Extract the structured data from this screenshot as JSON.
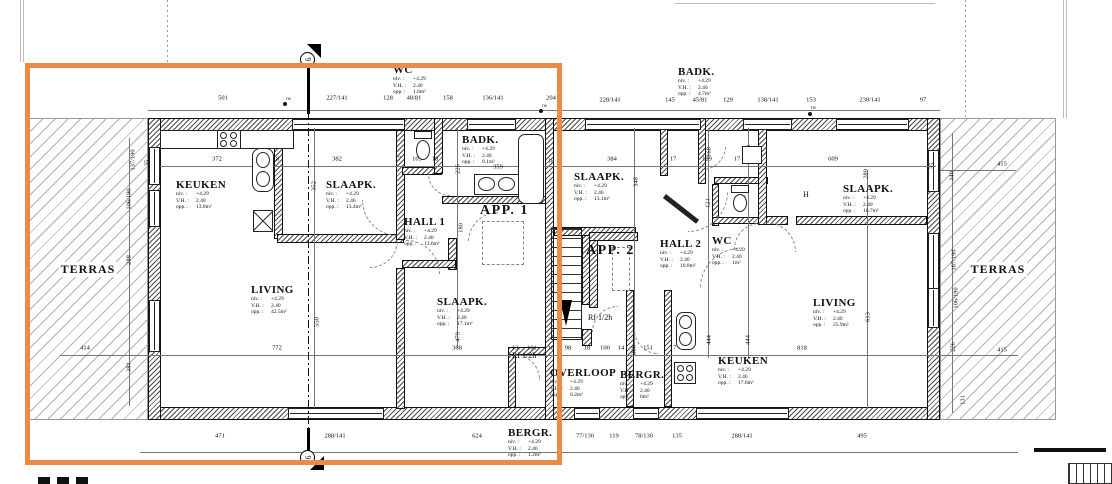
{
  "highlight": {
    "color": "#ec8b45"
  },
  "terraces": [
    "TERRAS",
    "TERRAS"
  ],
  "apartments": [
    {
      "label": "APP. 1",
      "x": 480,
      "y": 203
    },
    {
      "label": "APP. 2",
      "x": 586,
      "y": 243
    }
  ],
  "info_keys": {
    "niv": "niv. :",
    "vh": "V.H. :",
    "opp": "opp. :"
  },
  "rooms": [
    {
      "id": "keuken-a1",
      "name": "KEUKEN",
      "niv": "+4.29",
      "vh": "2.40",
      "opp": "13.8m²",
      "x": 176,
      "y": 179
    },
    {
      "id": "slaapk-a1-top",
      "name": "SLAAPK.",
      "niv": "+4.29",
      "vh": "2.40",
      "opp": "13.4m²",
      "x": 326,
      "y": 179
    },
    {
      "id": "wc-a1",
      "name": "WC",
      "niv": "+4.29",
      "vh": "2.40",
      "opp": "1.6m²",
      "x": 393,
      "y": 64
    },
    {
      "id": "badk-a1",
      "name": "BADK.",
      "niv": "+4.29",
      "vh": "2.40",
      "opp": "8.1m²",
      "x": 462,
      "y": 134
    },
    {
      "id": "hall-1",
      "name": "HALL 1",
      "niv": "+4.29",
      "vh": "2.40",
      "opp": "13.6m²",
      "x": 404,
      "y": 216
    },
    {
      "id": "living-a1",
      "name": "LIVING",
      "niv": "+4.29",
      "vh": "2.40",
      "opp": "42.5m²",
      "x": 251,
      "y": 284
    },
    {
      "id": "slaapk-a1-bottom",
      "name": "SLAAPK.",
      "niv": "+4.29",
      "vh": "2.40",
      "opp": "17.1m²",
      "x": 437,
      "y": 296
    },
    {
      "id": "bergr-a1",
      "name": "BERGR.",
      "niv": "+4.29",
      "vh": "2.40",
      "opp": "1.2m²",
      "x": 508,
      "y": 427
    },
    {
      "id": "slaapk-a2-mid",
      "name": "SLAAPK.",
      "niv": "+4.29",
      "vh": "2.40",
      "opp": "13.1m²",
      "x": 574,
      "y": 171
    },
    {
      "id": "badk-a2",
      "name": "BADK.",
      "niv": "+4.29",
      "vh": "2.40",
      "opp": "4.7m²",
      "x": 678,
      "y": 66
    },
    {
      "id": "hall-2",
      "name": "HALL 2",
      "niv": "+4.29",
      "vh": "2.40",
      "opp": "10.8m²",
      "x": 660,
      "y": 238
    },
    {
      "id": "wc-a2",
      "name": "WC",
      "niv": "+4.29",
      "vh": "2.40",
      "opp": "1m²",
      "x": 712,
      "y": 235
    },
    {
      "id": "slaapk-a2-right",
      "name": "SLAAPK.",
      "niv": "+4.29",
      "vh": "2.40",
      "opp": "16.7m²",
      "x": 843,
      "y": 183
    },
    {
      "id": "living-a2",
      "name": "LIVING",
      "niv": "+4.29",
      "vh": "2.40",
      "opp": "25.9m²",
      "x": 813,
      "y": 297
    },
    {
      "id": "keuken-a2",
      "name": "KEUKEN",
      "niv": "+4.29",
      "vh": "2.40",
      "opp": "17.6m²",
      "x": 718,
      "y": 355
    },
    {
      "id": "overloop",
      "name": "OVERLOOP",
      "niv": "+4.29",
      "vh": "2.40",
      "opp": "6.2m²",
      "x": 550,
      "y": 367
    },
    {
      "id": "bergr-a2",
      "name": "BERGR.",
      "niv": "+4.29",
      "vh": "2.40",
      "opp": "6m²",
      "x": 620,
      "y": 369
    }
  ],
  "fire_labels": [
    {
      "t": "Rf 1/2h",
      "x": 512,
      "y": 351
    },
    {
      "t": "Rf 1/2h",
      "x": 588,
      "y": 313
    }
  ],
  "annotations": [
    {
      "t": "rw",
      "x": 286,
      "y": 97
    },
    {
      "t": "rw",
      "x": 542,
      "y": 104
    },
    {
      "t": "rw",
      "x": 811,
      "y": 106
    },
    {
      "t": "H",
      "x": 803,
      "y": 190
    }
  ],
  "section_marker": {
    "label": "9"
  },
  "dims": [
    {
      "t": "501",
      "x": 223,
      "y": 98
    },
    {
      "t": "227/141",
      "x": 337,
      "y": 98
    },
    {
      "t": "128",
      "x": 388,
      "y": 98
    },
    {
      "t": "48/81",
      "x": 414,
      "y": 98
    },
    {
      "t": "158",
      "x": 448,
      "y": 98
    },
    {
      "t": "136/141",
      "x": 493,
      "y": 98
    },
    {
      "t": "204",
      "x": 551,
      "y": 98
    },
    {
      "t": "228/141",
      "x": 610,
      "y": 100
    },
    {
      "t": "145",
      "x": 670,
      "y": 100
    },
    {
      "t": "45/81",
      "x": 700,
      "y": 100
    },
    {
      "t": "129",
      "x": 728,
      "y": 100
    },
    {
      "t": "138/141",
      "x": 768,
      "y": 100
    },
    {
      "t": "153",
      "x": 811,
      "y": 100
    },
    {
      "t": "238/141",
      "x": 870,
      "y": 100
    },
    {
      "t": "97",
      "x": 923,
      "y": 100
    },
    {
      "t": "372",
      "x": 217,
      "y": 159
    },
    {
      "t": "18",
      "x": 276,
      "y": 159
    },
    {
      "t": "382",
      "x": 337,
      "y": 159
    },
    {
      "t": "17",
      "x": 398,
      "y": 159
    },
    {
      "t": "105",
      "x": 417,
      "y": 159
    },
    {
      "t": "18",
      "x": 435,
      "y": 159
    },
    {
      "t": "359",
      "x": 498,
      "y": 167
    },
    {
      "t": "18",
      "x": 551,
      "y": 161
    },
    {
      "t": "384",
      "x": 612,
      "y": 159
    },
    {
      "t": "17",
      "x": 673,
      "y": 159
    },
    {
      "t": "189",
      "x": 707,
      "y": 159
    },
    {
      "t": "17",
      "x": 737,
      "y": 159
    },
    {
      "t": "609",
      "x": 833,
      "y": 159
    },
    {
      "t": "415",
      "x": 1002,
      "y": 164
    },
    {
      "t": "35",
      "x": 147,
      "y": 163,
      "r": 1
    },
    {
      "t": "35",
      "x": 932,
      "y": 166,
      "r": 1
    },
    {
      "t": "137/190",
      "x": 133,
      "y": 160,
      "r": 1
    },
    {
      "t": "106/190",
      "x": 129,
      "y": 199,
      "r": 1
    },
    {
      "t": "288",
      "x": 129,
      "y": 260,
      "r": 1
    },
    {
      "t": "381",
      "x": 129,
      "y": 367,
      "r": 1
    },
    {
      "t": "352",
      "x": 314,
      "y": 186,
      "r": 1
    },
    {
      "t": "550",
      "x": 317,
      "y": 322,
      "r": 1
    },
    {
      "t": "226",
      "x": 458,
      "y": 169,
      "r": 1
    },
    {
      "t": "180",
      "x": 461,
      "y": 228,
      "r": 1
    },
    {
      "t": "479",
      "x": 458,
      "y": 337,
      "r": 1
    },
    {
      "t": "348",
      "x": 636,
      "y": 182,
      "r": 1
    },
    {
      "t": "398",
      "x": 634,
      "y": 350,
      "r": 1
    },
    {
      "t": "168",
      "x": 709,
      "y": 152,
      "r": 1
    },
    {
      "t": "168",
      "x": 749,
      "y": 150,
      "r": 1
    },
    {
      "t": "121",
      "x": 708,
      "y": 203,
      "r": 1
    },
    {
      "t": "140",
      "x": 744,
      "y": 200,
      "r": 1
    },
    {
      "t": "444",
      "x": 709,
      "y": 340,
      "r": 1
    },
    {
      "t": "444",
      "x": 748,
      "y": 340,
      "r": 1
    },
    {
      "t": "289",
      "x": 866,
      "y": 174,
      "r": 1
    },
    {
      "t": "613",
      "x": 868,
      "y": 317,
      "r": 1
    },
    {
      "t": "340",
      "x": 952,
      "y": 176,
      "r": 1
    },
    {
      "t": "167/190",
      "x": 954,
      "y": 260,
      "r": 1
    },
    {
      "t": "106/190",
      "x": 956,
      "y": 298,
      "r": 1
    },
    {
      "t": "226",
      "x": 953,
      "y": 347,
      "r": 1
    },
    {
      "t": "131",
      "x": 963,
      "y": 400,
      "r": 1
    },
    {
      "t": "414",
      "x": 85,
      "y": 348
    },
    {
      "t": "772",
      "x": 277,
      "y": 348
    },
    {
      "t": "17",
      "x": 398,
      "y": 348
    },
    {
      "t": "368",
      "x": 457,
      "y": 348
    },
    {
      "t": "13",
      "x": 515,
      "y": 348
    },
    {
      "t": "101",
      "x": 532,
      "y": 348
    },
    {
      "t": "18",
      "x": 551,
      "y": 348
    },
    {
      "t": "98",
      "x": 568,
      "y": 348
    },
    {
      "t": "18",
      "x": 587,
      "y": 348
    },
    {
      "t": "100",
      "x": 605,
      "y": 348
    },
    {
      "t": "14",
      "x": 621,
      "y": 348
    },
    {
      "t": "151",
      "x": 648,
      "y": 348
    },
    {
      "t": "17",
      "x": 673,
      "y": 348
    },
    {
      "t": "818",
      "x": 802,
      "y": 348
    },
    {
      "t": "415",
      "x": 1002,
      "y": 350
    },
    {
      "t": "471",
      "x": 220,
      "y": 436
    },
    {
      "t": "288/141",
      "x": 335,
      "y": 436
    },
    {
      "t": "624",
      "x": 477,
      "y": 436
    },
    {
      "t": "77/130",
      "x": 585,
      "y": 436
    },
    {
      "t": "119",
      "x": 614,
      "y": 436
    },
    {
      "t": "78/130",
      "x": 644,
      "y": 436
    },
    {
      "t": "135",
      "x": 677,
      "y": 436
    },
    {
      "t": "288/141",
      "x": 742,
      "y": 436
    },
    {
      "t": "495",
      "x": 862,
      "y": 436
    }
  ]
}
